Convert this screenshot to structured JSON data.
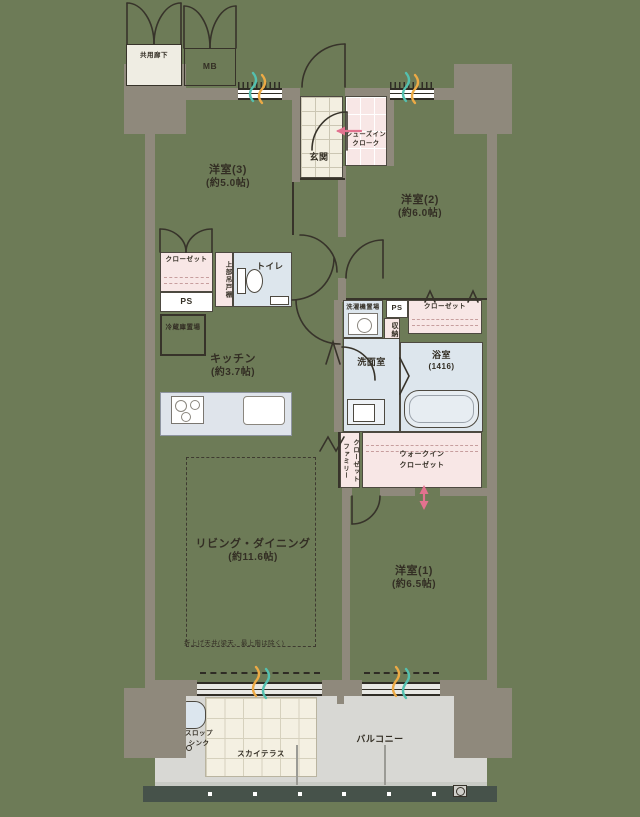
{
  "palette": {
    "background": "#6d7b57",
    "wall_gray": "#8f897c",
    "line_dark": "#37332a",
    "closet_pink": "#f8e7e6",
    "wet_area_blue": "#dde6ed",
    "tile_beige": "#f3efe1",
    "balcony_gray": "#d8d8d4",
    "railing_green": "#46524a",
    "accent_teal": "#54c0af",
    "accent_orange": "#ecaa45",
    "arrow_pink": "#e2728f"
  },
  "common_area": {
    "storage_label": "共用廊下",
    "meter_box_label": "MB"
  },
  "rooms": {
    "west3": {
      "name": "洋室(3)",
      "size": "(約5.0帖)"
    },
    "west2": {
      "name": "洋室(2)",
      "size": "(約6.0帖)"
    },
    "west1": {
      "name": "洋室(1)",
      "size": "(約6.5帖)"
    },
    "living": {
      "name": "リビング・ダイニング",
      "size": "(約11.6帖)",
      "ceiling_note": "折上げ天井(梁天、最上階は除く)"
    },
    "kitchen": {
      "name": "キッチン",
      "size": "(約3.7帖)",
      "fridge_space": "冷蔵庫置場"
    },
    "entrance": {
      "name": "玄関",
      "shoe_cloak_line1": "シューズイン",
      "shoe_cloak_line2": "クローク"
    },
    "toilet": {
      "name": "トイレ",
      "upper_cabinet": "上部吊戸棚"
    },
    "washroom": {
      "name": "洗面室",
      "laundry_space": "洗濯機置場"
    },
    "bath": {
      "name": "浴室",
      "size": "(1416)"
    }
  },
  "storage": {
    "closet_left": "クローゼット",
    "closet_right": "クローゼット",
    "ps_left": "PS",
    "ps_right": "PS",
    "cabinet": "収納",
    "family_closet_line1": "ファミリー",
    "family_closet_line2": "クローゼット",
    "walkin_line1": "ウォークイン",
    "walkin_line2": "クローゼット"
  },
  "outdoor": {
    "balcony": "バルコニー",
    "sky_terrace": "スカイテラス",
    "slop_sink_line1": "スロップ",
    "slop_sink_line2": "シンク"
  }
}
